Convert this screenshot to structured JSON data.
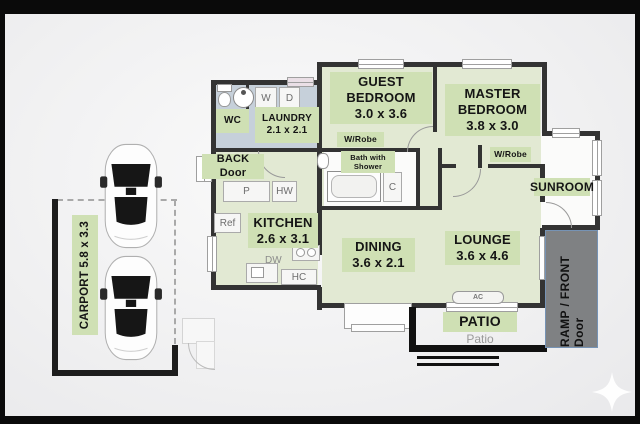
{
  "rooms": {
    "carport": {
      "label": "CARPORT 5.8 x 3.3"
    },
    "wc": {
      "label": "WC"
    },
    "laundry": {
      "name": "LAUNDRY",
      "dims": "2.1 x 2.1"
    },
    "back_door": {
      "label": "BACK Door"
    },
    "guest_bedroom": {
      "line1": "GUEST",
      "line2": "BEDROOM",
      "dims": "3.0 x 3.6"
    },
    "master_bedroom": {
      "line1": "MASTER",
      "line2": "BEDROOM",
      "dims": "3.8 x 3.0"
    },
    "guest_robe": {
      "label": "W/Robe"
    },
    "master_robe": {
      "label": "W/Robe"
    },
    "bathroom": {
      "line1": "Bath with",
      "line2": "Shower"
    },
    "sunroom": {
      "label": "SUNROOM"
    },
    "kitchen": {
      "name": "KITCHEN",
      "dims": "2.6 x 3.1"
    },
    "dining": {
      "name": "DINING",
      "dims": "3.6 x 2.1"
    },
    "lounge": {
      "name": "LOUNGE",
      "dims": "3.6 x 4.6"
    },
    "patio": {
      "label": "PATIO",
      "sublabel": "Patio"
    },
    "ramp": {
      "label": "RAMP / FRONT Door"
    }
  },
  "fixtures": {
    "pantry": "P",
    "hot_water": "HW",
    "fridge": "Ref",
    "dishwasher": "DW",
    "hot_cupboard": "HC",
    "washer": "W",
    "dryer": "D",
    "cupboard": "C",
    "air_con": "AC"
  },
  "colors": {
    "label_bg": "#cfe0b4",
    "floor_green": "#e2e9d3",
    "floor_laundry": "#c6d0da",
    "wall": "#333333",
    "ramp_bg": "#7f8183",
    "background": "#f1f1f2"
  }
}
